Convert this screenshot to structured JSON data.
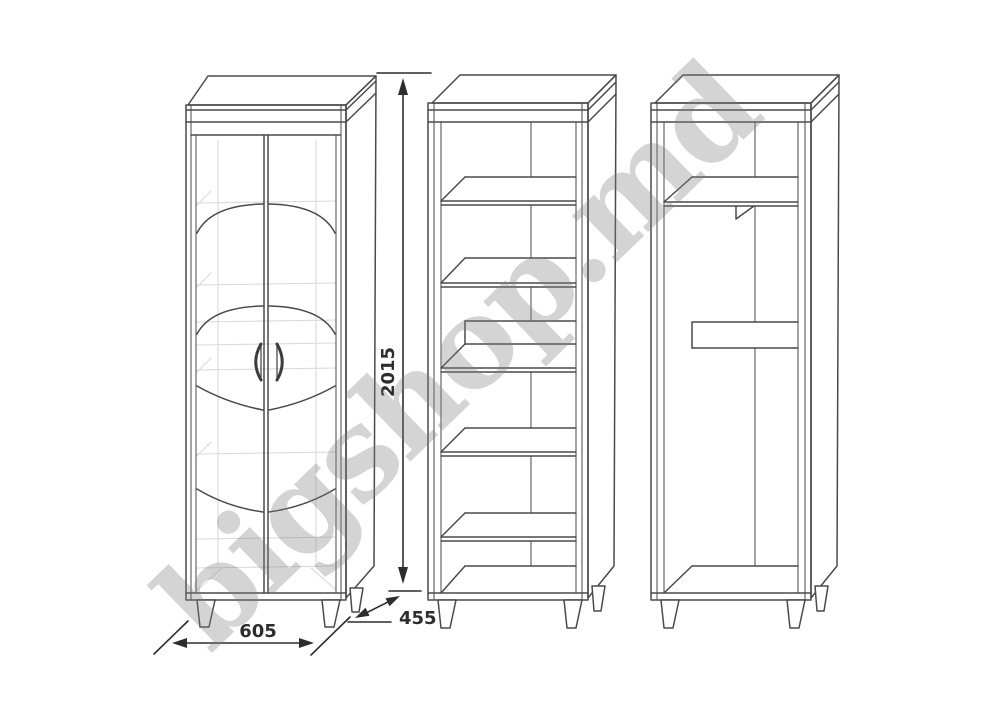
{
  "watermark": {
    "text": "bigshop.md",
    "color": "#7e7e7e"
  },
  "dimensions": {
    "height_mm": "2015",
    "width_mm": "605",
    "depth_mm": "455"
  },
  "colors": {
    "line": "#4a4a4a",
    "dimension": "#2d2d2d",
    "faint_interior": "#d9d9d9",
    "background": "#ffffff"
  }
}
